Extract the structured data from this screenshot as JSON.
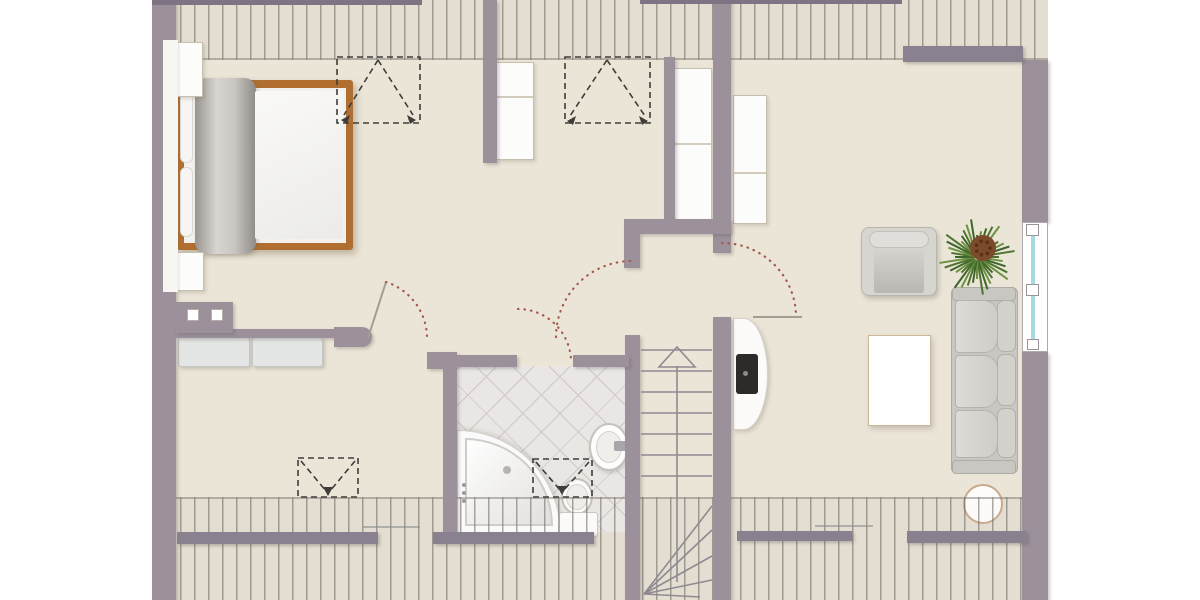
{
  "app": {
    "type": "architectural-floor-plan",
    "storey": "attic",
    "visible_text": "none"
  },
  "palette": {
    "page_bg": "#ffffff",
    "floor": "#ebe5d7",
    "roof_band": "#e3ded1",
    "wall": "#9c919b",
    "beam": "#8a8190",
    "bed_frame": "#b06f30",
    "tile_line": "#cdc8c6",
    "window_glass": "#a8d9e0",
    "door_swing": "#a3584b",
    "symbol_dash": "#3f3d3a",
    "furniture_gray": "#d3d1cc"
  },
  "canvas": {
    "width": 1200,
    "height": 600
  },
  "elements": [
    [
      "building-floor",
      "floorbase",
      152,
      0,
      896,
      600,
      0
    ],
    [
      "roof-band-top-bg",
      "bandbg",
      152,
      0,
      896,
      60,
      0
    ],
    [
      "roof-band-bottom-bg",
      "bandbg",
      152,
      497,
      896,
      103,
      0
    ],
    [
      "bathroom-tile-floor",
      "tiles",
      457,
      366,
      169,
      166,
      1
    ],
    [
      "corner-bathtub-outer",
      "tub-out",
      457,
      430,
      104,
      104,
      2
    ],
    [
      "corner-bathtub-inner",
      "tub-in",
      465,
      438,
      88,
      88,
      2
    ],
    [
      "bathtub-drain",
      "dot",
      503,
      466,
      8,
      8,
      2,
      {
        "background": "#b7b4b0"
      }
    ],
    [
      "bathtub-jet-1",
      "dot",
      462,
      483,
      4,
      4,
      2,
      {
        "background": "#9a97a0"
      }
    ],
    [
      "bathtub-jet-2",
      "dot",
      462,
      491,
      4,
      4,
      2,
      {
        "background": "#9a97a0"
      }
    ],
    [
      "bathtub-jet-3",
      "dot",
      462,
      499,
      4,
      4,
      2,
      {
        "background": "#9a97a0"
      }
    ],
    [
      "toilet-bowl",
      "wc-bowl",
      561,
      478,
      32,
      37,
      2
    ],
    [
      "toilet-bowl-inner",
      "sink-in",
      566,
      484,
      22,
      26,
      2
    ],
    [
      "toilet-tank",
      "wc-tank",
      559,
      512,
      39,
      25,
      2
    ],
    [
      "round-side-table",
      "rtable",
      963,
      484,
      40,
      40,
      2
    ],
    [
      "roof-band-top-hatch",
      "stripes stripes-top",
      152,
      0,
      896,
      60,
      3
    ],
    [
      "roof-band-bottom-hatch",
      "stripes stripes-bottom",
      152,
      497,
      896,
      103,
      3
    ],
    [
      "bed-frame",
      "bedframe",
      176,
      80,
      177,
      170,
      4
    ],
    [
      "bed-inner",
      "bedinner",
      184,
      88,
      162,
      155,
      4
    ],
    [
      "bed-headboard-cushion-1",
      "hb",
      180,
      92,
      13,
      71,
      4
    ],
    [
      "bed-headboard-cushion-2",
      "hb",
      180,
      167,
      13,
      70,
      4
    ],
    [
      "bed-blanket-roll",
      "roll",
      195,
      78,
      61,
      176,
      4
    ],
    [
      "bed-duvet",
      "duvet",
      255,
      91,
      88,
      148,
      4
    ],
    [
      "bedside-cabinet-top",
      "cab",
      175,
      42,
      28,
      55,
      4
    ],
    [
      "bedside-cabinet-bottom",
      "cab",
      175,
      252,
      29,
      39,
      4
    ],
    [
      "bench-cushion-left",
      "bench",
      178,
      337,
      72,
      30,
      4
    ],
    [
      "bench-cushion-right",
      "bench",
      252,
      337,
      71,
      30,
      4
    ],
    [
      "wardrobe-top-middle",
      "cab",
      496,
      62,
      38,
      98,
      4
    ],
    [
      "wardrobe-top-middle-shelf-line",
      "cabline",
      497,
      96,
      36,
      2,
      4
    ],
    [
      "wardrobe-hall-left",
      "cab",
      674,
      68,
      38,
      153,
      4
    ],
    [
      "wardrobe-hall-left-shelf-line",
      "cabline",
      675,
      143,
      36,
      2,
      4
    ],
    [
      "wardrobe-hall-right",
      "cab",
      733,
      95,
      34,
      129,
      4
    ],
    [
      "wardrobe-hall-right-shelf-line",
      "cabline",
      734,
      172,
      32,
      2,
      4
    ],
    [
      "tv-board",
      "tvboard",
      733,
      318,
      35,
      112,
      4
    ],
    [
      "tv-screen",
      "tv",
      736,
      354,
      22,
      40,
      4
    ],
    [
      "tv-power-dot",
      "dot",
      743,
      371,
      5,
      5,
      4,
      {
        "background": "#8d8a88"
      }
    ],
    [
      "armchair-base",
      "chair-out",
      861,
      227,
      76,
      69,
      4
    ],
    [
      "armchair-back-roll",
      "chair-roll",
      869,
      231,
      60,
      17,
      4
    ],
    [
      "armchair-seat",
      "chair-seat",
      874,
      248,
      50,
      45,
      4
    ],
    [
      "sofa-base",
      "sofa-arm",
      951,
      287,
      67,
      187,
      4,
      {
        "borderRadius": "6px"
      }
    ],
    [
      "sofa-armrest-top",
      "sofa-arm",
      952,
      287,
      64,
      14,
      4
    ],
    [
      "sofa-armrest-bottom",
      "sofa-arm",
      952,
      460,
      64,
      14,
      4
    ],
    [
      "sofa-back-cushion-1",
      "sofa-back",
      997,
      300,
      19,
      52,
      4
    ],
    [
      "sofa-back-cushion-2",
      "sofa-back",
      997,
      354,
      19,
      52,
      4
    ],
    [
      "sofa-back-cushion-3",
      "sofa-back",
      997,
      408,
      19,
      50,
      4
    ],
    [
      "sofa-seat-cushion-1",
      "sofa-seat",
      955,
      300,
      43,
      53,
      4
    ],
    [
      "sofa-seat-cushion-2",
      "sofa-seat",
      955,
      355,
      43,
      53,
      4
    ],
    [
      "sofa-seat-cushion-3",
      "sofa-seat",
      955,
      410,
      43,
      48,
      4
    ],
    [
      "coffee-table",
      "table",
      868,
      335,
      63,
      91,
      4
    ],
    [
      "bathroom-sink",
      "sink",
      589,
      423,
      40,
      48,
      4
    ],
    [
      "bathroom-sink-basin",
      "sink-in",
      596,
      431,
      26,
      32,
      4
    ],
    [
      "sink-tap",
      "tap",
      614,
      441,
      16,
      10,
      4
    ],
    [
      "outer-wall-left",
      "wall",
      152,
      0,
      24,
      600,
      5
    ],
    [
      "bedroom-wall-lining",
      "lining",
      163,
      40,
      15,
      252,
      5
    ],
    [
      "outer-wall-right-upper",
      "wall",
      1022,
      60,
      26,
      162,
      5
    ],
    [
      "outer-wall-right-lower",
      "wall",
      1022,
      352,
      26,
      248,
      5
    ],
    [
      "window-right-frame",
      "win",
      1022,
      222,
      26,
      130,
      5
    ],
    [
      "window-right-glass",
      "bluline",
      1031,
      236,
      4,
      104,
      5
    ],
    [
      "divider-wall-top",
      "wall",
      483,
      0,
      14,
      163,
      5
    ],
    [
      "divider-wall-mid",
      "wall",
      664,
      57,
      11,
      168,
      5
    ],
    [
      "stair-wall-right-upper",
      "wall",
      713,
      0,
      18,
      253,
      5
    ],
    [
      "stair-wall-right-lower",
      "wall",
      713,
      317,
      18,
      283,
      5
    ],
    [
      "stair-top-wall",
      "wall",
      624,
      219,
      107,
      15,
      5
    ],
    [
      "stair-wall-left-upper",
      "wall",
      624,
      233,
      16,
      35,
      5
    ],
    [
      "stair-wall-left-lower",
      "wall",
      625,
      335,
      15,
      265,
      5
    ],
    [
      "bedroom-south-wall",
      "wall",
      176,
      329,
      160,
      9,
      5
    ],
    [
      "bedroom-door-jamb",
      "wall",
      334,
      327,
      38,
      20,
      5,
      {
        "borderRadius": "0 12px 12px 0"
      }
    ],
    [
      "bedroom-wall-protrusion",
      "wall",
      176,
      302,
      57,
      31,
      5
    ],
    [
      "bathroom-corner-nub",
      "wall",
      427,
      352,
      17,
      17,
      5
    ],
    [
      "bathroom-west-wall",
      "wall",
      443,
      352,
      14,
      186,
      5
    ],
    [
      "bathroom-north-wall-left",
      "wall",
      455,
      355,
      62,
      12,
      5
    ],
    [
      "bathroom-north-wall-right",
      "wall",
      573,
      355,
      56,
      12,
      5
    ],
    [
      "roof-beam-top-right",
      "beam",
      903,
      46,
      120,
      16,
      6
    ],
    [
      "roof-beam-bottom-1",
      "beam",
      177,
      532,
      201,
      12,
      6
    ],
    [
      "roof-beam-bottom-2",
      "beam",
      433,
      532,
      161,
      12,
      6
    ],
    [
      "roof-beam-bottom-3",
      "beam",
      737,
      531,
      115,
      10,
      6
    ],
    [
      "roof-beam-bottom-4",
      "beam",
      907,
      531,
      120,
      12,
      6
    ],
    [
      "roof-edge-top-left",
      "sliver",
      152,
      0,
      270,
      5,
      6
    ],
    [
      "roof-edge-top-mid",
      "sliver",
      640,
      0,
      262,
      4,
      6
    ],
    [
      "wall-niche-box-1",
      "sq",
      187,
      309,
      12,
      12,
      6
    ],
    [
      "wall-niche-box-2",
      "sq",
      211,
      309,
      12,
      12,
      6
    ],
    [
      "window-handle-top",
      "winsq",
      1026,
      224,
      13,
      12,
      6
    ],
    [
      "window-handle-mid",
      "winsq",
      1026,
      284,
      13,
      12,
      6
    ],
    [
      "window-handle-bottom",
      "winsq",
      1027,
      339,
      12,
      11,
      6
    ],
    [
      "knee-wall-line-left",
      "kneeline",
      363,
      526,
      57,
      2,
      6
    ],
    [
      "knee-wall-line-right",
      "kneeline",
      815,
      525,
      58,
      2,
      6
    ]
  ],
  "svg": [
    {
      "name": "stair-tread-1",
      "tag": "line",
      "attrs": {
        "x1": 641,
        "y1": 350,
        "x2": 712,
        "y2": 350,
        "class": "tread"
      }
    },
    {
      "name": "stair-tread-2",
      "tag": "line",
      "attrs": {
        "x1": 641,
        "y1": 371,
        "x2": 712,
        "y2": 371,
        "class": "tread"
      }
    },
    {
      "name": "stair-tread-3",
      "tag": "line",
      "attrs": {
        "x1": 641,
        "y1": 392,
        "x2": 712,
        "y2": 392,
        "class": "tread"
      }
    },
    {
      "name": "stair-tread-4",
      "tag": "line",
      "attrs": {
        "x1": 641,
        "y1": 413,
        "x2": 712,
        "y2": 413,
        "class": "tread"
      }
    },
    {
      "name": "stair-tread-5",
      "tag": "line",
      "attrs": {
        "x1": 641,
        "y1": 434,
        "x2": 712,
        "y2": 434,
        "class": "tread"
      }
    },
    {
      "name": "stair-tread-6",
      "tag": "line",
      "attrs": {
        "x1": 641,
        "y1": 455,
        "x2": 712,
        "y2": 455,
        "class": "tread"
      }
    },
    {
      "name": "stair-tread-7",
      "tag": "line",
      "attrs": {
        "x1": 641,
        "y1": 476,
        "x2": 712,
        "y2": 476,
        "class": "tread"
      }
    },
    {
      "name": "stair-walk-line",
      "tag": "line",
      "attrs": {
        "x1": 677,
        "y1": 366,
        "x2": 677,
        "y2": 582,
        "class": "tread"
      }
    },
    {
      "name": "stair-direction-arrow",
      "tag": "path",
      "attrs": {
        "d": "M677 347 L659 367 L695 367 Z",
        "class": "tread"
      }
    },
    {
      "name": "stair-winder-1",
      "tag": "line",
      "attrs": {
        "x1": 644,
        "y1": 594,
        "x2": 712,
        "y2": 506,
        "class": "tread"
      }
    },
    {
      "name": "stair-winder-2",
      "tag": "line",
      "attrs": {
        "x1": 644,
        "y1": 594,
        "x2": 712,
        "y2": 530,
        "class": "tread"
      }
    },
    {
      "name": "stair-winder-3",
      "tag": "line",
      "attrs": {
        "x1": 644,
        "y1": 594,
        "x2": 712,
        "y2": 556,
        "class": "tread"
      }
    },
    {
      "name": "stair-winder-4",
      "tag": "line",
      "attrs": {
        "x1": 644,
        "y1": 594,
        "x2": 712,
        "y2": 580,
        "class": "tread"
      }
    },
    {
      "name": "stair-winder-5",
      "tag": "line",
      "attrs": {
        "x1": 644,
        "y1": 594,
        "x2": 700,
        "y2": 597,
        "class": "tread"
      }
    },
    {
      "name": "roof-window-bedroom-top",
      "tag": "rect",
      "attrs": {
        "x": 337,
        "y": 57,
        "width": 83,
        "height": 66,
        "class": "dashline"
      }
    },
    {
      "name": "roof-window-bedroom-top-diag-l",
      "tag": "path",
      "attrs": {
        "d": "M378 60 L344 115",
        "class": "dashline"
      }
    },
    {
      "name": "roof-window-bedroom-top-diag-r",
      "tag": "path",
      "attrs": {
        "d": "M378 60 L413 115",
        "class": "dashline"
      }
    },
    {
      "name": "roof-window-bedroom-top-arrow-l",
      "tag": "path",
      "attrs": {
        "d": "M341 120 l9 -5 l-3 9 z",
        "class": "ah"
      }
    },
    {
      "name": "roof-window-bedroom-top-arrow-r",
      "tag": "path",
      "attrs": {
        "d": "M416 120 l-9 -5 l3 9 z",
        "class": "ah"
      }
    },
    {
      "name": "roof-window-hall-top",
      "tag": "rect",
      "attrs": {
        "x": 565,
        "y": 57,
        "width": 85,
        "height": 66,
        "class": "dashline"
      }
    },
    {
      "name": "roof-window-hall-top-diag-l",
      "tag": "path",
      "attrs": {
        "d": "M607 60 L570 116",
        "class": "dashline"
      }
    },
    {
      "name": "roof-window-hall-top-diag-r",
      "tag": "path",
      "attrs": {
        "d": "M607 60 L645 116",
        "class": "dashline"
      }
    },
    {
      "name": "roof-window-hall-top-arrow-l",
      "tag": "path",
      "attrs": {
        "d": "M567 121 l9 -5 l-3 9 z",
        "class": "ah"
      }
    },
    {
      "name": "roof-window-hall-top-arrow-r",
      "tag": "path",
      "attrs": {
        "d": "M648 121 l-9 -5 l3 9 z",
        "class": "ah"
      }
    },
    {
      "name": "roof-window-landing-bottom",
      "tag": "rect",
      "attrs": {
        "x": 298,
        "y": 458,
        "width": 60,
        "height": 39,
        "class": "dashline"
      }
    },
    {
      "name": "roof-window-landing-diag-l",
      "tag": "path",
      "attrs": {
        "d": "M301 461 L326 491",
        "class": "dashline"
      }
    },
    {
      "name": "roof-window-landing-diag-r",
      "tag": "path",
      "attrs": {
        "d": "M355 461 L330 491",
        "class": "dashline"
      }
    },
    {
      "name": "roof-window-landing-arrow",
      "tag": "path",
      "attrs": {
        "d": "M328 496 l-5 -9 l10 0 z",
        "class": "ah"
      }
    },
    {
      "name": "roof-window-bathroom",
      "tag": "rect",
      "attrs": {
        "x": 533,
        "y": 459,
        "width": 59,
        "height": 38,
        "class": "dashline"
      }
    },
    {
      "name": "roof-window-bathroom-diag-l",
      "tag": "path",
      "attrs": {
        "d": "M536 462 L560 490",
        "class": "dashline"
      }
    },
    {
      "name": "roof-window-bathroom-diag-r",
      "tag": "path",
      "attrs": {
        "d": "M589 462 L564 490",
        "class": "dashline"
      }
    },
    {
      "name": "roof-window-bathroom-arrow",
      "tag": "path",
      "attrs": {
        "d": "M562 495 l-5 -9 l10 0 z",
        "class": "ah"
      }
    },
    {
      "name": "bedroom-door-leaf",
      "tag": "line",
      "attrs": {
        "x1": 368,
        "y1": 338,
        "x2": 386,
        "y2": 282,
        "class": "leaf"
      }
    },
    {
      "name": "bedroom-door-swing-arc",
      "tag": "path",
      "attrs": {
        "d": "M386 282 A59 59 0 0 1 427 338",
        "class": "arcdot"
      }
    },
    {
      "name": "bathroom-door-swing-arc",
      "tag": "path",
      "attrs": {
        "d": "M518 309 A53 53 0 0 1 571 362",
        "class": "arcdot"
      }
    },
    {
      "name": "stair-door-swing-arc",
      "tag": "path",
      "attrs": {
        "d": "M556 337 A76 76 0 0 1 632 261",
        "class": "arcdot"
      }
    },
    {
      "name": "living-door-swing-arc",
      "tag": "path",
      "attrs": {
        "d": "M722 243 A74 74 0 0 1 796 317",
        "class": "arcdot"
      }
    },
    {
      "name": "living-door-leaf",
      "tag": "line",
      "attrs": {
        "x1": 753,
        "y1": 317,
        "x2": 802,
        "y2": 317,
        "class": "leaf"
      }
    }
  ],
  "plant": {
    "cx": 977,
    "cy": 257,
    "leaf_colors": [
      "#4e7530",
      "#6d9142",
      "#3e652b"
    ],
    "core_color": "#7c4b2b",
    "core_dot_color": "#5a3017"
  }
}
